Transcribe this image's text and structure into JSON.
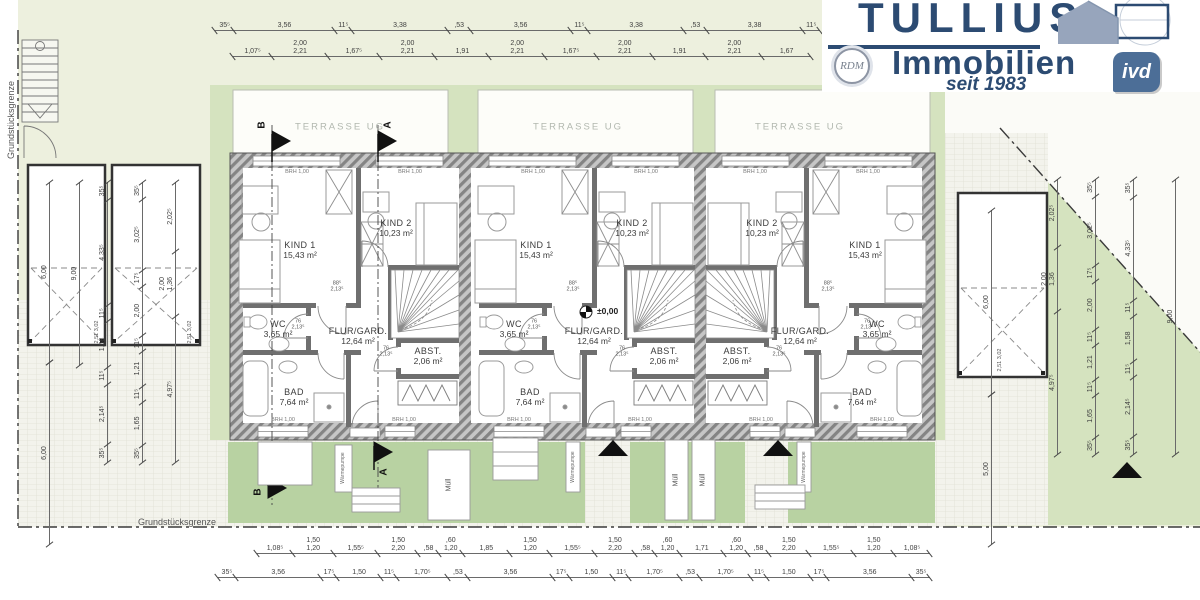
{
  "brand": {
    "title": "TULLIUS",
    "subtitle": "Immobilien",
    "tagline": "seit 1983",
    "badge_rdm": "RDM",
    "badge_ivd": "ivd",
    "color": "#2c4b72"
  },
  "labels": {
    "terrace": "TERRASSE UG",
    "boundary": "Grundstücksgrenze",
    "level": "±0,00",
    "trash": "Müll",
    "heat_pump": "Wärmepumpe",
    "window_sill": "BRH 1,00",
    "section_a": "A",
    "section_b": "B",
    "door_size_88": "88⁵\n2,13⁵",
    "door_size_76": "76\n2,13⁵",
    "garage_small": "2,51\n3,02"
  },
  "units": [
    {
      "rooms": {
        "kind1": {
          "name": "KIND 1",
          "area": "15,43 m²"
        },
        "kind2": {
          "name": "KIND 2",
          "area": "10,23 m²"
        },
        "wc": {
          "name": "WC",
          "area": "3,65 m²"
        },
        "flur": {
          "name": "FLUR/GARD.",
          "area": "12,64 m²"
        },
        "abst": {
          "name": "ABST.",
          "area": "2,06 m²"
        },
        "bad": {
          "name": "BAD",
          "area": "7,64 m²"
        }
      }
    },
    {
      "rooms": {
        "kind1": {
          "name": "KIND 1",
          "area": "15,43 m²"
        },
        "kind2": {
          "name": "KIND 2",
          "area": "10,23 m²"
        },
        "wc": {
          "name": "WC",
          "area": "3,65 m²"
        },
        "flur": {
          "name": "FLUR/GARD.",
          "area": "12,64 m²"
        },
        "abst": {
          "name": "ABST.",
          "area": "2,06 m²"
        },
        "bad": {
          "name": "BAD",
          "area": "7,64 m²"
        }
      }
    },
    {
      "rooms": {
        "kind1": {
          "name": "KIND 1",
          "area": "15,43 m²"
        },
        "kind2": {
          "name": "KIND 2",
          "area": "10,23 m²"
        },
        "wc": {
          "name": "WC",
          "area": "3,65 m²"
        },
        "flur": {
          "name": "FLUR/GARD.",
          "area": "12,64 m²"
        },
        "abst": {
          "name": "ABST.",
          "area": "2,06 m²"
        },
        "bad": {
          "name": "BAD",
          "area": "7,64 m²"
        }
      }
    }
  ],
  "dims": {
    "top_outer": [
      "35⁵",
      "3,56",
      "11⁵",
      "3,38",
      ",53",
      "3,56",
      "11⁵",
      "3,38",
      ",53",
      "3,38",
      "11⁵"
    ],
    "top_inner": [
      "1,07⁵",
      "2,00\n2,21",
      "1,67⁵",
      "2,00\n2,21",
      "1,91",
      "2,00\n2,21",
      "1,67⁵",
      "2,00\n2,21",
      "1,91",
      "2,00\n2,21",
      "1,67"
    ],
    "bottom_inner": [
      "1,08⁵",
      "1,50\n1,20",
      "1,55⁵",
      "1,50\n2,20",
      ",58",
      ",60\n1,20",
      "1,85",
      "1,50\n1,20",
      "1,55⁵",
      "1,50\n2,20",
      ",58",
      ",60\n1,20",
      "1,71",
      ",60\n1,20",
      ",58",
      "1,50\n2,20",
      "1,55⁵",
      "1,50\n1,20",
      "1,08⁵"
    ],
    "bottom_outer": [
      "35⁵",
      "3,56",
      "17⁵",
      "1,50",
      "11⁵",
      "1,70⁵",
      ",53",
      "3,56",
      "17⁵",
      "1,50",
      "11⁵",
      "1,70⁵",
      ",53",
      "1,70⁵",
      "11⁵",
      "1,50",
      "17⁵",
      "3,56",
      "35⁵"
    ],
    "left_a": [
      "35⁵",
      "2,14⁵",
      "11⁵",
      "1,58",
      "11⁵",
      "4,33⁵",
      "35⁵"
    ],
    "left_b": [
      "35⁵",
      "1,65",
      "11⁵",
      "1,21",
      "11⁵",
      "2,00",
      "17⁵",
      "3,02⁵",
      "35⁵"
    ],
    "left_c": [
      "4,97⁵",
      "2,00\n1,36",
      "2,02⁵"
    ],
    "right_a": [
      "4,97⁵",
      "2,00\n1,36",
      "2,02⁵"
    ],
    "right_b": [
      "35⁵",
      "1,65",
      "11⁵",
      "1,21",
      "11⁵",
      "2,00",
      "17⁵",
      "3,02⁵",
      "35⁵"
    ],
    "right_c": [
      "35⁵",
      "2,14⁵",
      "11⁵",
      "1,58",
      "11⁵",
      "4,33⁵",
      "35⁵"
    ],
    "right_total": [
      "9,00"
    ],
    "garage_width": [
      "6,00"
    ],
    "garage_length": [
      "9,00"
    ],
    "left_front": [
      "6,00"
    ],
    "right_front": [
      "5,00"
    ],
    "right_garage_width": [
      "6,00"
    ]
  }
}
